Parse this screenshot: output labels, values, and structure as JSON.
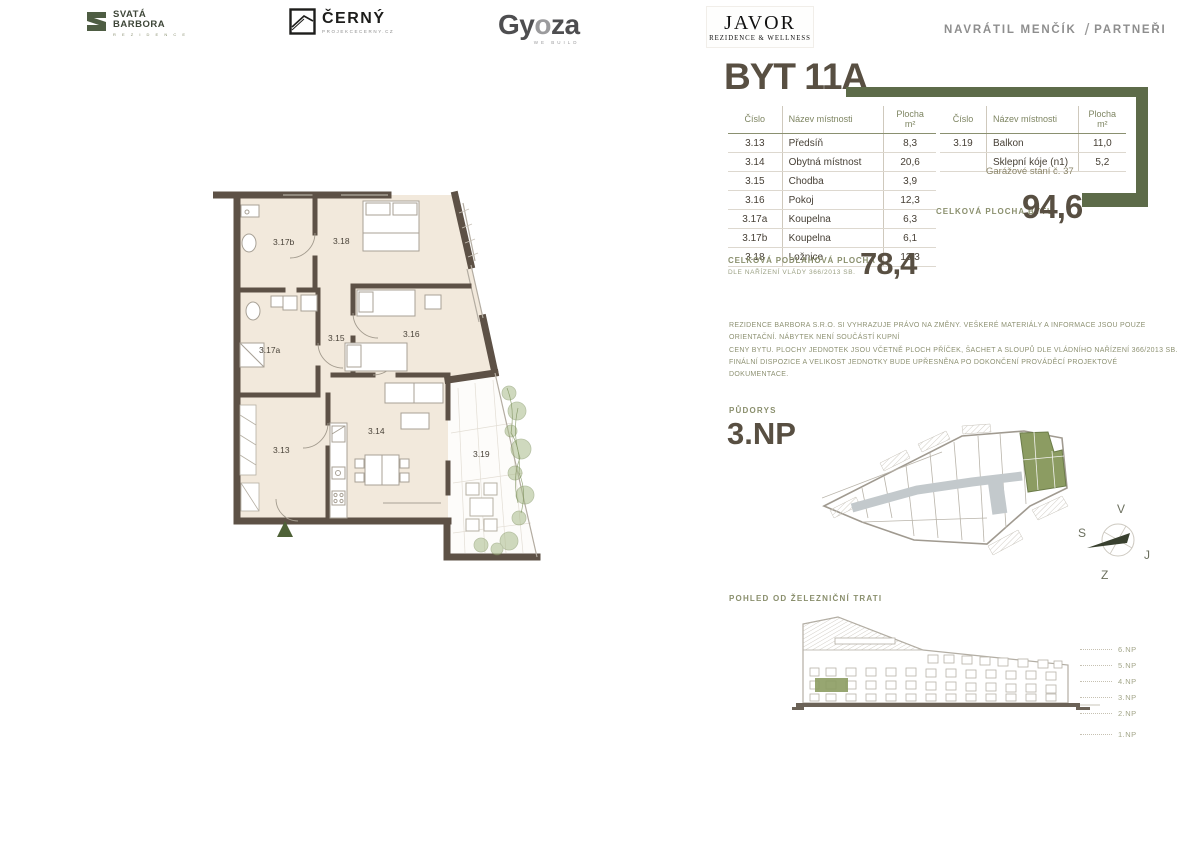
{
  "unit": {
    "title": "BYT 11A",
    "rooms_table": {
      "headers": [
        "Číslo",
        "Název místnosti",
        "Plocha m²"
      ],
      "left_rows": [
        [
          "3.13",
          "Předsíň",
          "8,3"
        ],
        [
          "3.14",
          "Obytná místnost",
          "20,6"
        ],
        [
          "3.15",
          "Chodba",
          "3,9"
        ],
        [
          "3.16",
          "Pokoj",
          "12,3"
        ],
        [
          "3.17a",
          "Koupelna",
          "6,3"
        ],
        [
          "3.17b",
          "Koupelna",
          "6,1"
        ],
        [
          "3.18",
          "Ložnice",
          "13,3"
        ]
      ],
      "right_rows": [
        [
          "3.19",
          "Balkon",
          "11,0"
        ],
        [
          "",
          "Sklepní kóje (n1)",
          "5,2"
        ]
      ],
      "garage_note": "Garážové stání č. 37"
    },
    "total_area": {
      "label": "CELKOVÁ PLOCHA BYTU",
      "value": "94,6"
    },
    "floor_area": {
      "line1": "CELKOVÁ PODLAHOVÁ PLOCHA",
      "line2": "DLE NAŘÍZENÍ VLÁDY 366/2013 SB.",
      "value": "78,4"
    },
    "disclaimer": "REZIDENCE BARBORA S.R.O. SI VYHRAZUJE PRÁVO NA ZMĚNY. VEŠKERÉ MATERIÁLY A INFORMACE JSOU POUZE ORIENTAČNÍ. NÁBYTEK NENÍ SOUČÁSTÍ KUPNÍ\nCENY BYTU. PLOCHY JEDNOTEK JSOU VČETNĚ PLOCH PŘÍČEK, ŠACHET A SLOUPŮ DLE VLÁDNÍHO NAŘÍZENÍ 366/2013 SB.\nFINÁLNÍ DISPOZICE A VELIKOST JEDNOTKY BUDE UPŘESNĚNA PO DOKONČENÍ PROVÁDĚCÍ PROJEKTOVÉ DOKUMENTACE."
  },
  "floorplan": {
    "labels": {
      "r313": "3.13",
      "r314": "3.14",
      "r315": "3.15",
      "r316": "3.16",
      "r317a": "3.17a",
      "r317b": "3.17b",
      "r318": "3.18",
      "r319": "3.19"
    }
  },
  "site": {
    "section_label": "PŮDORYS",
    "floor": "3.NP"
  },
  "compass": {
    "v": "V",
    "s": "S",
    "j": "J",
    "z": "Z"
  },
  "elevation": {
    "section_label": "POHLED OD ŽELEZNIČNÍ TRATI",
    "floor_labels": [
      "6.NP",
      "5.NP",
      "4.NP",
      "3.NP",
      "2.NP",
      "1.NP"
    ]
  },
  "footer": {
    "barbora": {
      "line1": "SVATÁ",
      "line2": "BARBORA",
      "sub": "R E Z I D E N C E"
    },
    "cerny": {
      "name": "ČERNÝ",
      "sub": "PROJEKCECERNY.CZ"
    },
    "gyoza": {
      "p1": "Gy",
      "p2": "o",
      "p3": "za",
      "sub": "WE BUILD"
    },
    "javor": {
      "name": "JAVOR",
      "sub": "REZIDENCE & WELLNESS"
    },
    "navratil": {
      "name": "NAVRÁTIL MENČÍK",
      "slash": "/",
      "partner": "PARTNEŘI"
    }
  },
  "colors": {
    "accent_olive": "#5d6b49",
    "highlight_green": "#8c9c62",
    "wall_brown": "#5d5146",
    "floor_cream": "#f2e9dc",
    "title_taupe": "#584f42"
  }
}
